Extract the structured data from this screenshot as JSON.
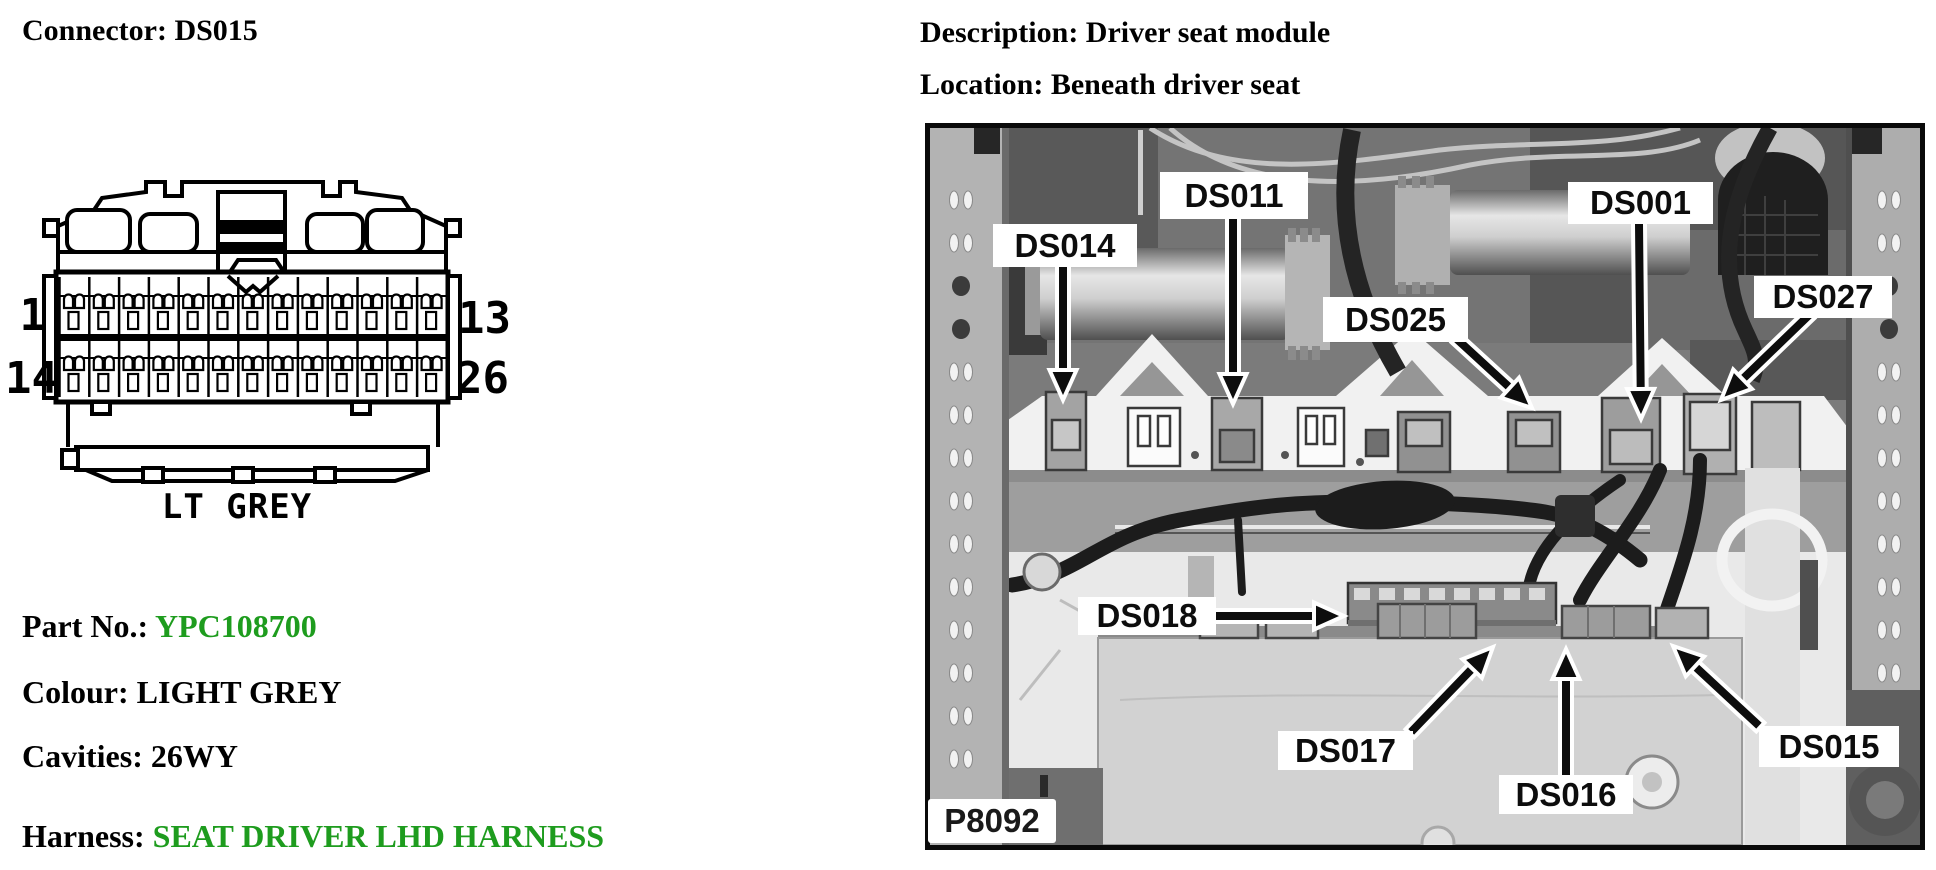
{
  "colors": {
    "green_value": "#1e9c1e",
    "text_black": "#000000",
    "photo_bg": "#7b7b7b",
    "callout_bg": "#ffffff",
    "callout_text": "#0d0d0d"
  },
  "left": {
    "title": "Connector: DS015",
    "diagram": {
      "pin_top_left": "1",
      "pin_top_right": "13",
      "pin_bottom_left": "14",
      "pin_bottom_right": "26",
      "color_label": "LT GREY",
      "rows": 2,
      "pins_per_row": 13
    },
    "fields": [
      {
        "label": "Part No.:",
        "value": "YPC108700",
        "value_class": "val-green"
      },
      {
        "label": "Colour:",
        "value": "LIGHT GREY",
        "value_class": "val-black"
      },
      {
        "label": "Cavities:",
        "value": "26WY",
        "value_class": "val-black"
      },
      {
        "label": "Harness:",
        "value": "SEAT DRIVER LHD HARNESS",
        "value_class": "val-green"
      }
    ]
  },
  "right": {
    "description": "Description: Driver seat module",
    "location": "Location: Beneath driver seat",
    "photo": {
      "figure_code": "P8092",
      "figure_box": [
        928,
        799,
        128,
        44
      ],
      "callouts": [
        {
          "text": "DS014",
          "box": [
            993,
            224,
            144,
            43
          ],
          "arrow": [
            1063,
            267,
            1063,
            400
          ]
        },
        {
          "text": "DS011",
          "box": [
            1160,
            172,
            148,
            47
          ],
          "arrow": [
            1233,
            219,
            1233,
            404
          ]
        },
        {
          "text": "DS001",
          "box": [
            1568,
            182,
            145,
            42
          ],
          "arrow": [
            1639,
            224,
            1641,
            419
          ]
        },
        {
          "text": "DS025",
          "box": [
            1323,
            297,
            145,
            45
          ],
          "arrow": [
            1460,
            342,
            1532,
            408
          ]
        },
        {
          "text": "DS027",
          "box": [
            1754,
            276,
            138,
            42
          ],
          "arrow": [
            1806,
            318,
            1721,
            400
          ]
        },
        {
          "text": "DS018",
          "box": [
            1078,
            597,
            138,
            38
          ],
          "arrow": [
            1220,
            616,
            1344,
            616
          ]
        },
        {
          "text": "DS017",
          "box": [
            1278,
            731,
            135,
            39
          ],
          "arrow": [
            1414,
            729,
            1493,
            647
          ]
        },
        {
          "text": "DS016",
          "box": [
            1499,
            775,
            134,
            39
          ],
          "arrow": [
            1566,
            773,
            1566,
            649
          ]
        },
        {
          "text": "DS015",
          "box": [
            1759,
            726,
            140,
            41
          ],
          "arrow": [
            1756,
            723,
            1673,
            646
          ]
        }
      ]
    }
  }
}
